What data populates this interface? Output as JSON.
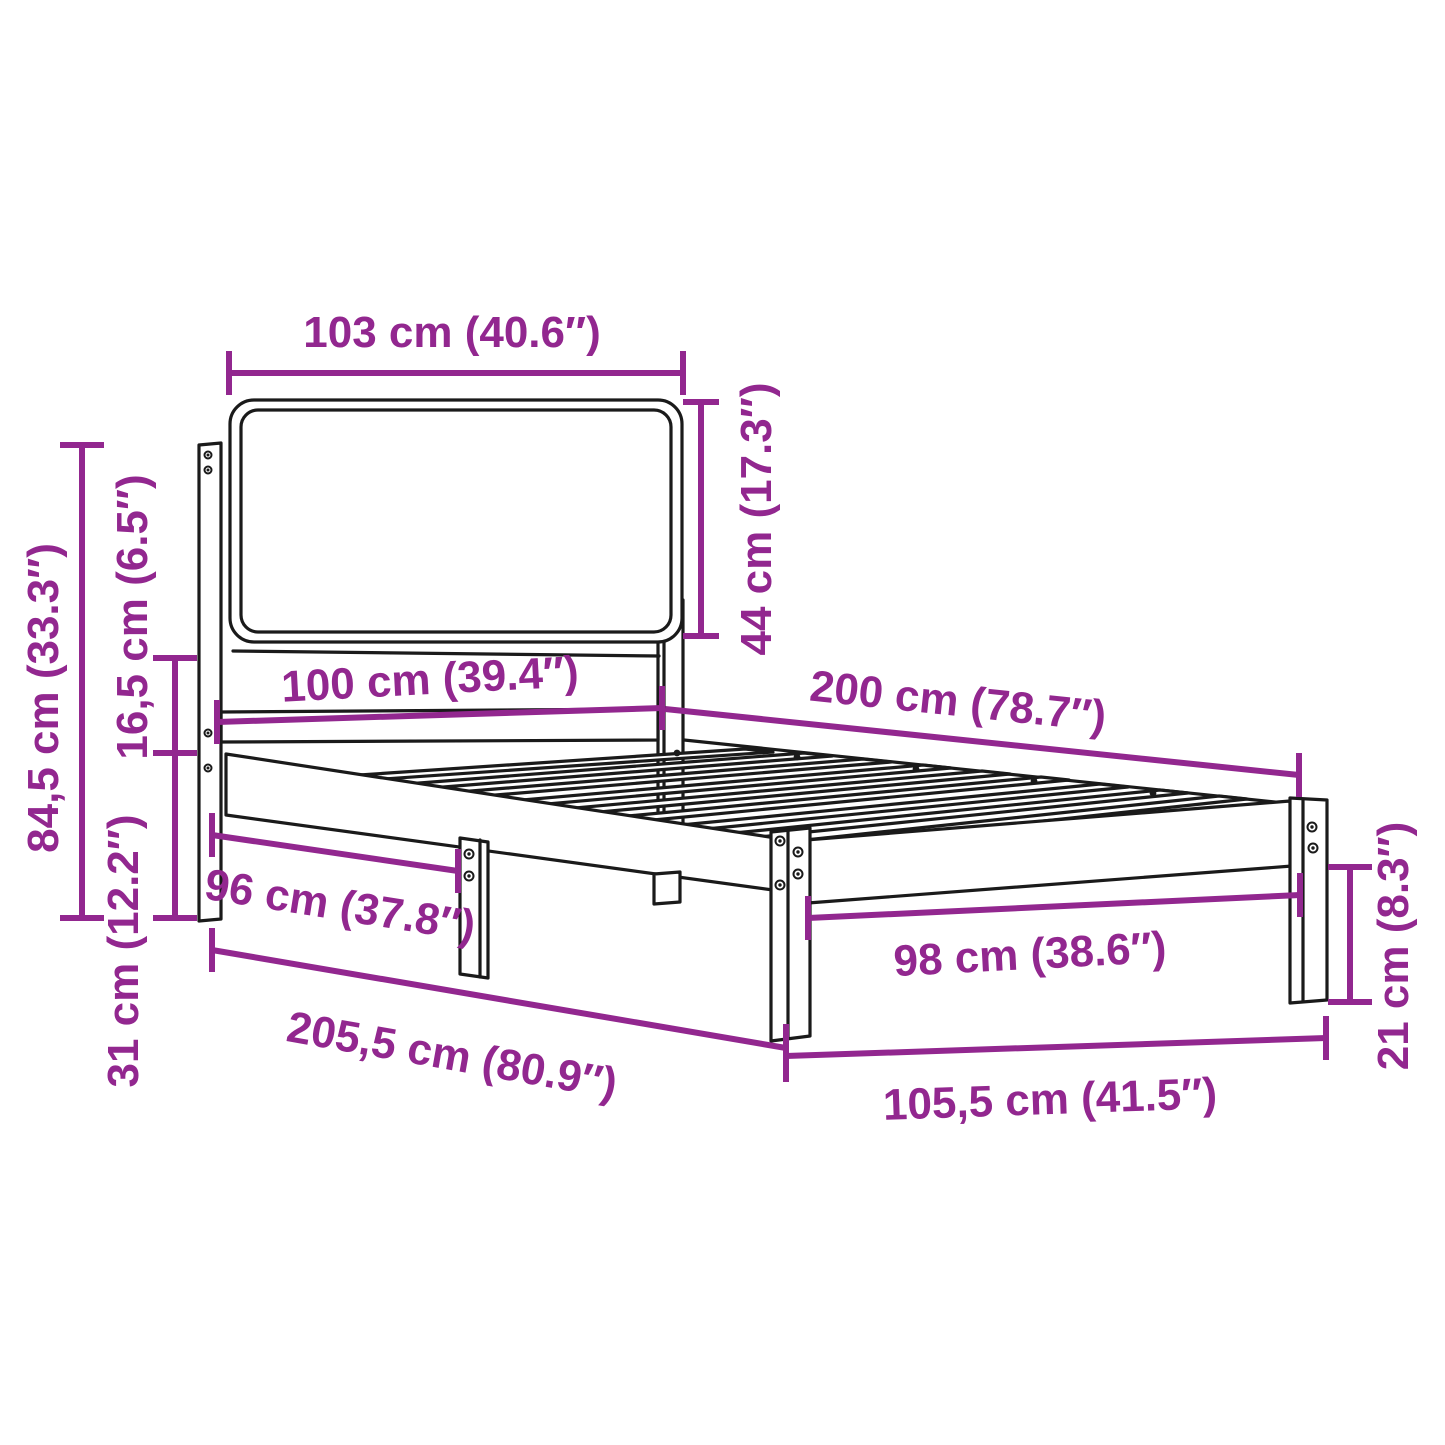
{
  "diagram": {
    "type": "product-dimension-diagram",
    "subject": "single bed frame with upholstered headboard, perspective line drawing",
    "units": "centimeters with inches in parentheses",
    "colors": {
      "dimension_text_and_lines": "#92278F",
      "linework": "#1A1A1A",
      "background": "#FFFFFF"
    },
    "dimensions": {
      "headboard_width": {
        "label": "103 cm (40.6″)"
      },
      "headboard_panel_height": {
        "label": "44 cm (17.3″)"
      },
      "total_height": {
        "label": "84,5 cm (33.3″)"
      },
      "panel_to_frame_gap": {
        "label": "16,5 cm (6.5″)"
      },
      "frame_floor_height": {
        "label": "31 cm (12.2″)"
      },
      "bed_width": {
        "label": "100 cm (39.4″)"
      },
      "bed_length": {
        "label": "200 cm (78.7″)"
      },
      "inner_width_head_end": {
        "label": "96 cm (37.8″)"
      },
      "inner_width_foot_end": {
        "label": "98 cm (38.6″)"
      },
      "total_length": {
        "label": "205,5 cm (80.9″)"
      },
      "total_width": {
        "label": "105,5 cm (41.5″)"
      },
      "leg_height": {
        "label": "21 cm (8.3″)"
      }
    }
  }
}
